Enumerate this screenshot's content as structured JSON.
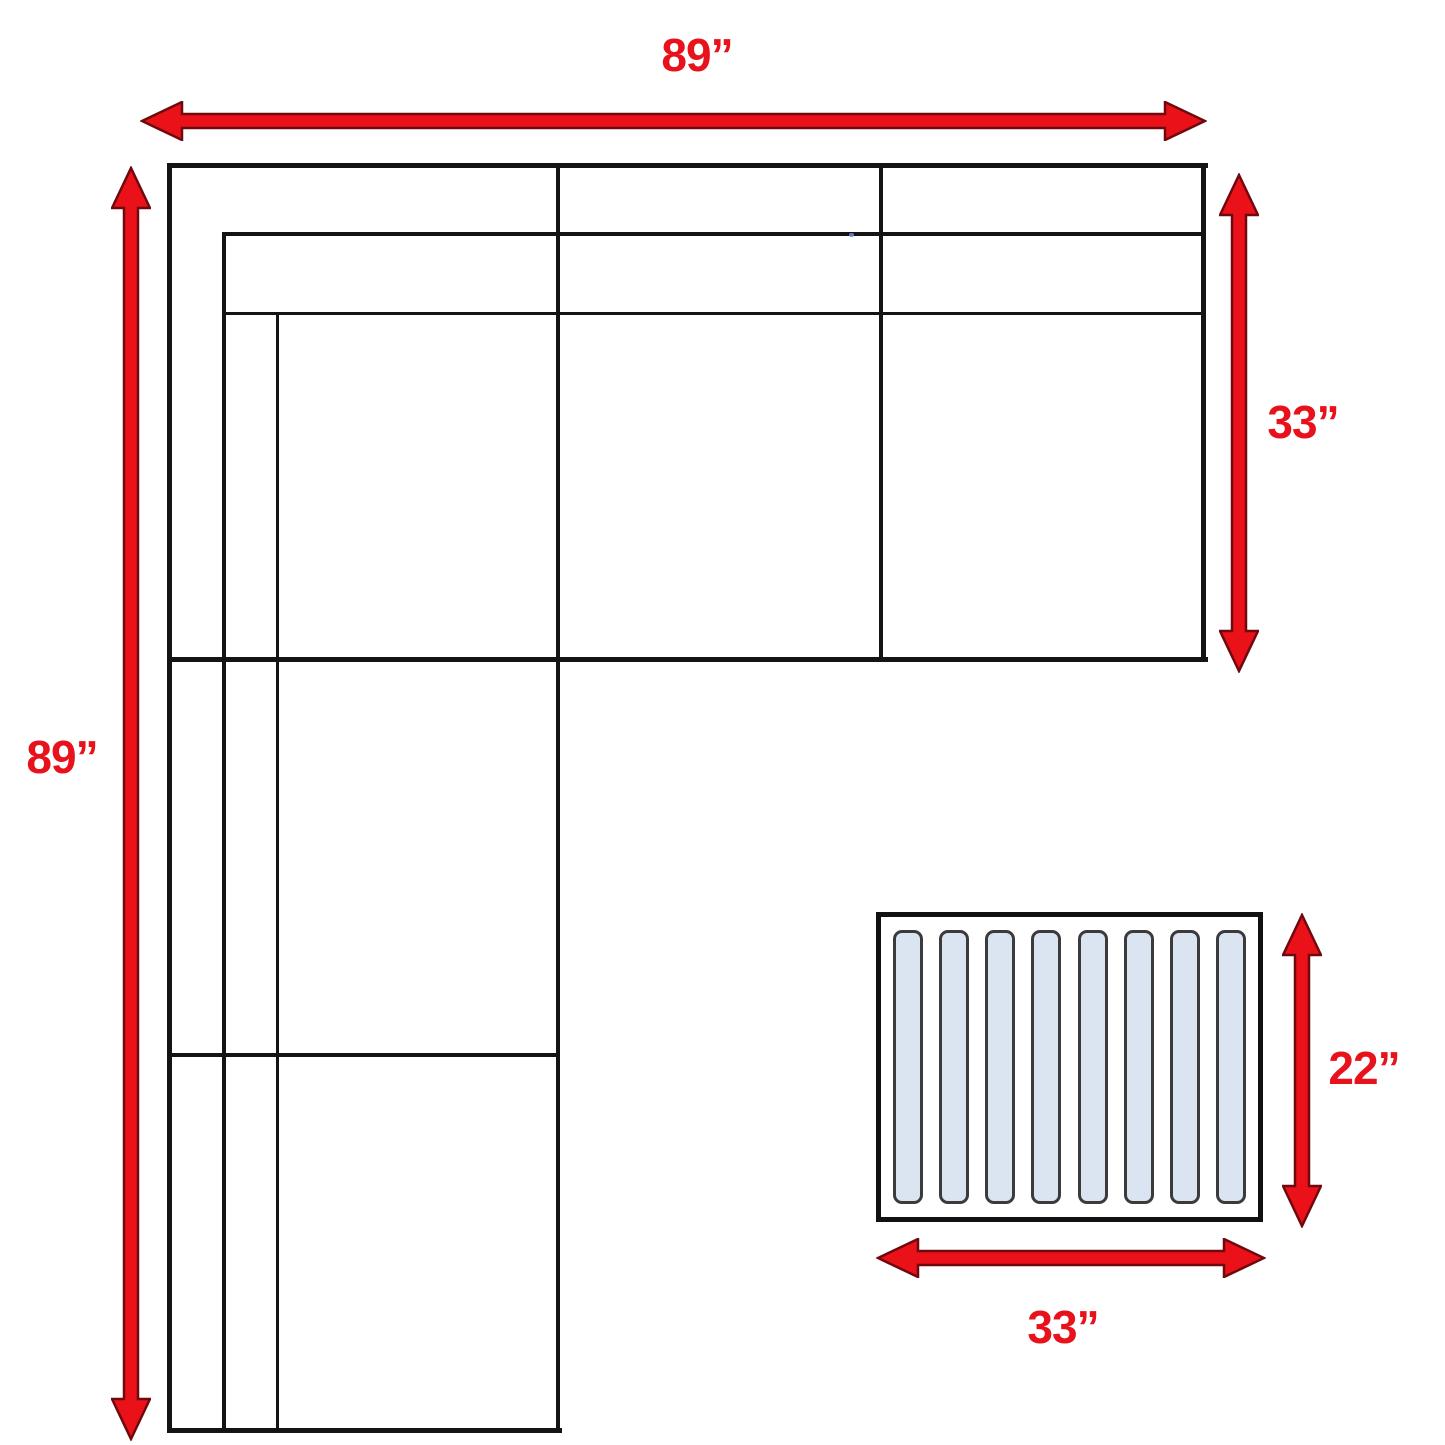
{
  "diagram": {
    "subject": "sectional-sofa-with-ottoman-dimension-diagram"
  },
  "measurements": {
    "sofa_width_top": "89”",
    "sofa_length_left": "89”",
    "sofa_depth_right": "33”",
    "ottoman_depth": "22”",
    "ottoman_width": "33”"
  },
  "ottoman": {
    "slat_count": 8
  },
  "colors": {
    "arrow_red": "#ea1118",
    "arrow_outline": "#70090d",
    "label_red": "#e8121c",
    "line_black": "#141414",
    "slat_fill": "#dbe5f1",
    "slat_border": "#3b3b3b"
  }
}
